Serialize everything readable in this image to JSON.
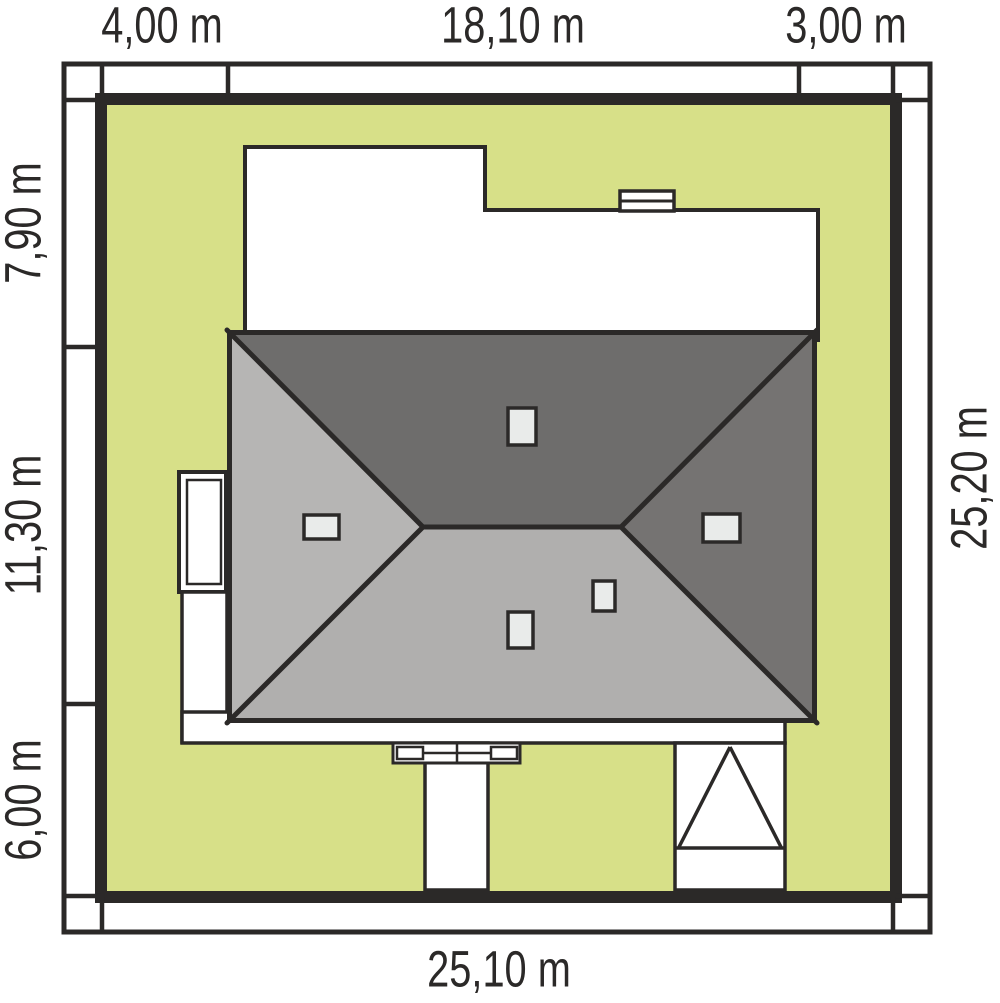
{
  "site_plan": {
    "dimensions": {
      "top": [
        "4,00 m",
        "18,10 m",
        "3,00 m"
      ],
      "left": [
        "7,90 m",
        "11,30 m",
        "6,00 m"
      ],
      "right": "25,20 m",
      "bottom": "25,10 m"
    },
    "colors": {
      "lawn": "#d7e088",
      "outline": "#2b2928",
      "footprint": "#ffffff",
      "roof_north_face": "#6e6d6c",
      "roof_east_face": "#757372",
      "roof_south_face": "#b0afae",
      "roof_west_face": "#b6b5b4",
      "chimney": "#e9ebea"
    }
  }
}
